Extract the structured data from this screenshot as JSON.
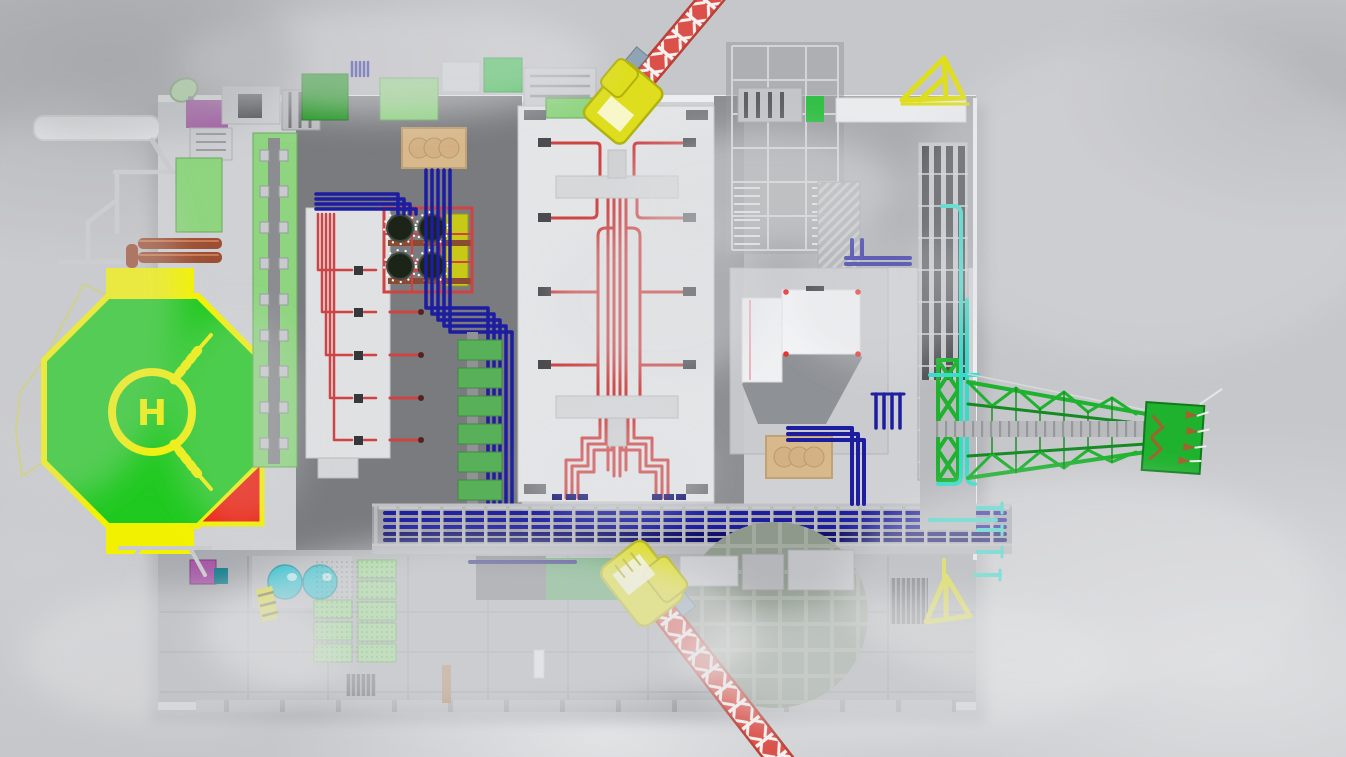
{
  "meta": {
    "scene_description": "Top-down 3D rendering of an offshore oil and gas platform topside floating in gray clouds",
    "render_type": "3d-render",
    "canvas": {
      "width": 1346,
      "height": 757
    }
  },
  "helipad": {
    "marking": "H"
  },
  "components": [
    "helipad",
    "pedestal-crane-north",
    "pedestal-crane-south",
    "crane-lattice-boom-north",
    "crane-lattice-boom-south",
    "flare-boom",
    "flare-tip-burners",
    "scaffold-tower",
    "white-building",
    "tan-tank-bank-left",
    "tan-tank-bank-right",
    "cooler-modules-green",
    "compressor-skid",
    "red-process-manifold",
    "blue-piping-bundle",
    "pipe-corridor",
    "teal-utility-piping",
    "copper-vessels",
    "teal-spheres",
    "pipe-rack-tower",
    "tiled-landing-pad",
    "boat-davit-northeast",
    "boat-davit-southeast",
    "satellite-dish",
    "long-green-module",
    "white-valve-module",
    "grating-panels"
  ],
  "colors": {
    "sky": "#c6c7ca",
    "sky_dark": "#a7a8ac",
    "sky_light": "#dedfe1",
    "deck_light": "#cfd1d4",
    "deck_pale": "#e3e5e7",
    "deck_mid": "#a8abaf",
    "deck_dark": "#77797d",
    "deck_edge_white": "#eceef0",
    "panel_line": "#94969a",
    "helipad_green": "#1fc91f",
    "helipad_yellow": "#f2f200",
    "helipad_red": "#ee1a0a",
    "crane_yellow": "#dede1e",
    "crane_yellow_dark": "#b2b20e",
    "boom_red": "#db5048",
    "boom_red_dark": "#bc3f38",
    "boom_white": "#f4f2f0",
    "flare_green": "#1eb22e",
    "flare_green_dark": "#148a22",
    "pipe_red": "#cf4343",
    "pipe_blue": "#1d1da0",
    "pipe_blue_dark": "#12126e",
    "pipe_teal": "#38dbc9",
    "pipe_copper": "#9c4f33",
    "module_green_light": "#8fd580",
    "module_green_mid": "#58b058",
    "module_green_dark": "#149114",
    "module_green_bright": "#33c047",
    "deck_green": "#4f9e5c",
    "tank_tan": "#d8b98c",
    "tank_tan_dark": "#c2a173",
    "box_purple": "#a655a6",
    "sphere_teal": "#14bac9",
    "building_white": "#f3f4f6",
    "building_shadow": "#8e9196",
    "tile_pad": "#8e998c",
    "tile_grout": "#a2aa9f",
    "grate_gray": "#b9bbbe",
    "frame_gray": "#c9cbce"
  }
}
